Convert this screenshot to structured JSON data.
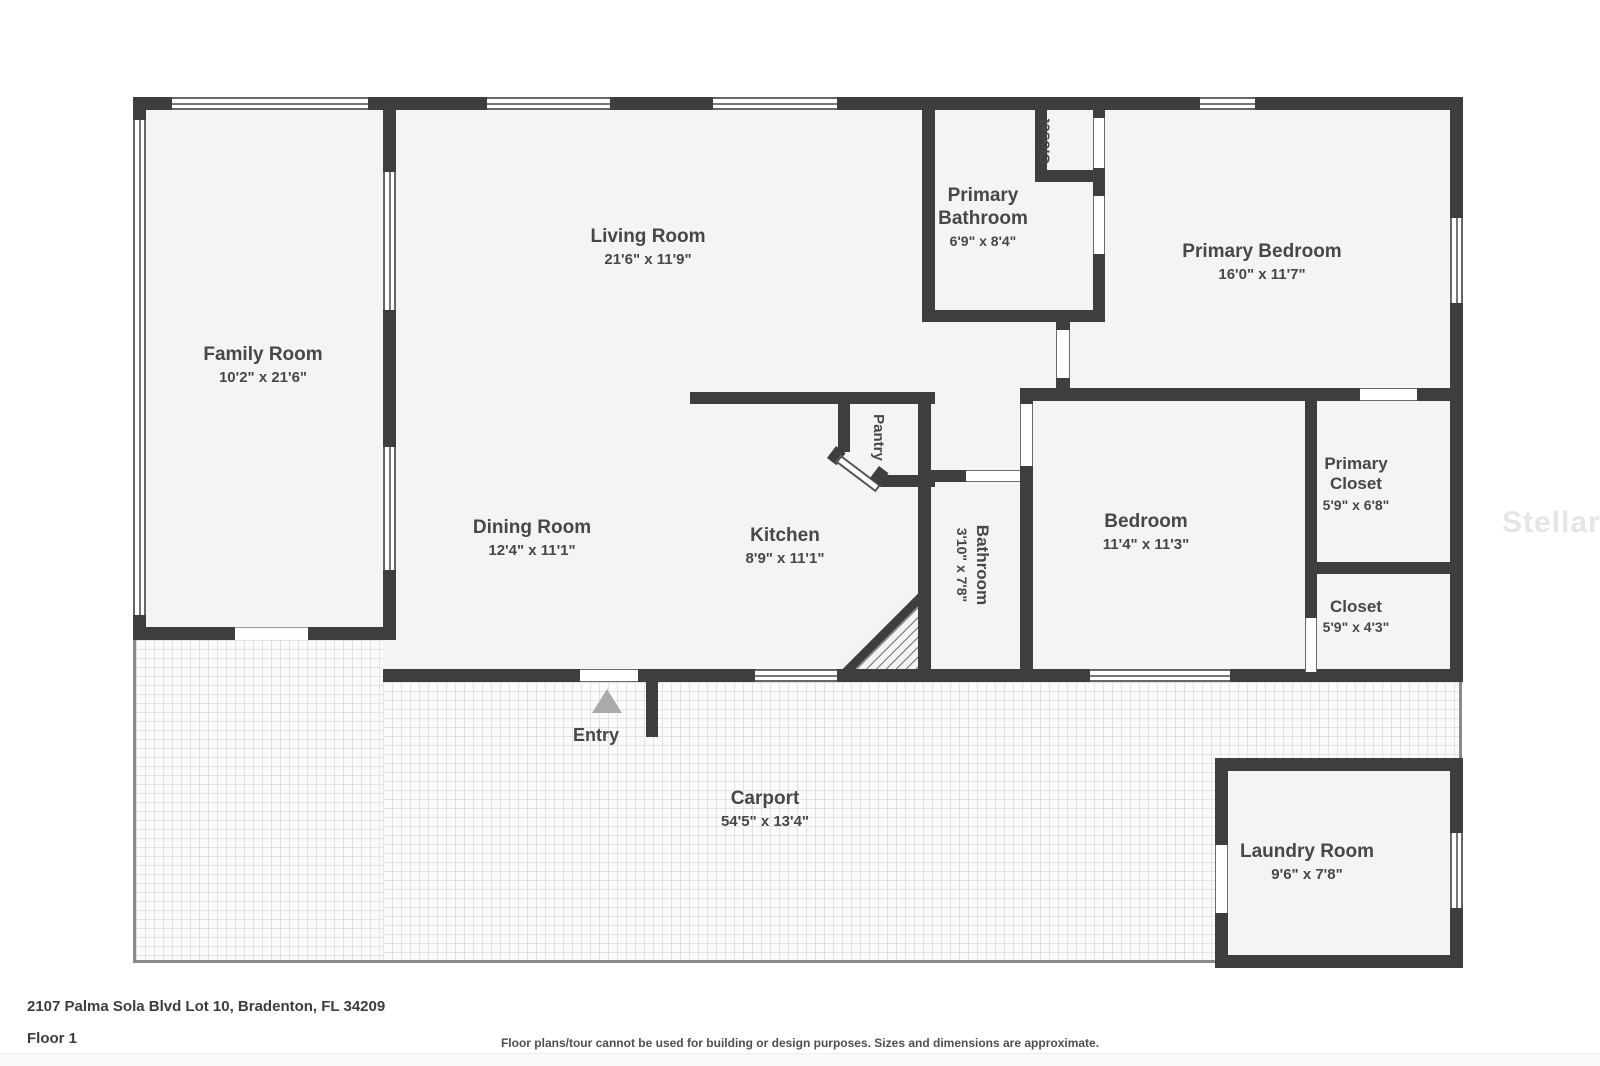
{
  "rooms": {
    "family": {
      "name": "Family Room",
      "dims": "10'2\" x 21'6\""
    },
    "living": {
      "name": "Living Room",
      "dims": "21'6\" x 11'9\""
    },
    "primary_bathroom": {
      "name": "Primary Bathroom",
      "dims": "6'9\" x 8'4\""
    },
    "closet_top": {
      "name": "Closet"
    },
    "primary_bedroom": {
      "name": "Primary Bedroom",
      "dims": "16'0\" x 11'7\""
    },
    "pantry": {
      "name": "Pantry"
    },
    "dining": {
      "name": "Dining Room",
      "dims": "12'4\" x 11'1\""
    },
    "kitchen": {
      "name": "Kitchen",
      "dims": "8'9\" x 11'1\""
    },
    "bathroom": {
      "name": "Bathroom",
      "dims": "3'10\" x 7'8\""
    },
    "bedroom": {
      "name": "Bedroom",
      "dims": "11'4\" x 11'3\""
    },
    "primary_closet": {
      "name": "Primary Closet",
      "dims": "5'9\" x 6'8\""
    },
    "closet": {
      "name": "Closet",
      "dims": "5'9\" x 4'3\""
    },
    "carport": {
      "name": "Carport",
      "dims": "54'5\" x 13'4\""
    },
    "laundry": {
      "name": "Laundry Room",
      "dims": "9'6\" x 7'8\""
    }
  },
  "entry": {
    "label": "Entry"
  },
  "watermark": "StellarMLS",
  "footer": {
    "address": "2107 Palma Sola Blvd Lot 10, Bradenton, FL 34209",
    "floor": "Floor 1",
    "disclaimer": "Floor plans/tour cannot be used for building or design purposes. Sizes and dimensions are approximate."
  },
  "colors": {
    "wall": "#3e3e3e",
    "floor": "#f4f4f4",
    "text": "#474747"
  }
}
